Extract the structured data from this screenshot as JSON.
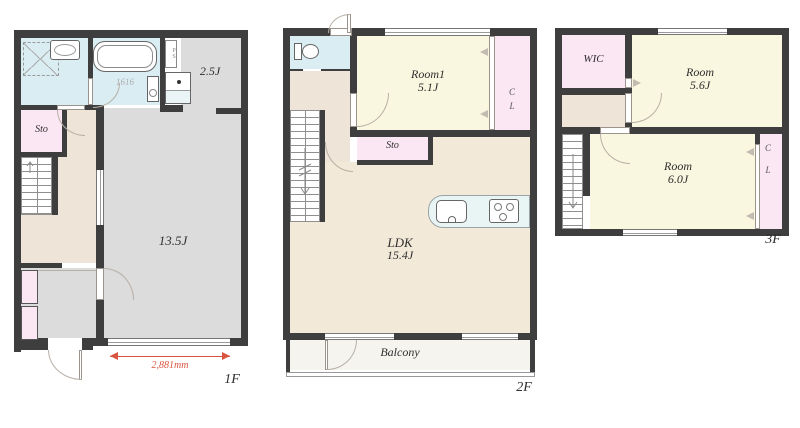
{
  "colors": {
    "wall": "#3e3e3e",
    "bathroom_floor": "#d9edf2",
    "closet_floor": "#fbe7f3",
    "hallway_floor": "#eee4d8",
    "gray_room_floor": "#dcdcdc",
    "bedroom_floor": "#faf7e0",
    "ldk_floor": "#f3e9d8",
    "balcony_floor": "#f5f4ef",
    "dimension_red": "#d9543f"
  },
  "floor1": {
    "floor_label": "1F",
    "main_room": "13.5J",
    "upper_room": "2.5J",
    "storage": "Sto",
    "bathtub": "1616",
    "pipe_space": "PS",
    "dimension": "2,881mm"
  },
  "floor2": {
    "floor_label": "2F",
    "room1_name": "Room1",
    "room1_size": "5.1J",
    "storage": "Sto",
    "ldk_name": "LDK",
    "ldk_size": "15.4J",
    "balcony": "Balcony",
    "closet_c": "C",
    "closet_l": "L"
  },
  "floor3": {
    "floor_label": "3F",
    "wic": "WIC",
    "upper_room_name": "Room",
    "upper_room_size": "5.6J",
    "lower_room_name": "Room",
    "lower_room_size": "6.0J",
    "closet_c": "C",
    "closet_l": "L"
  }
}
